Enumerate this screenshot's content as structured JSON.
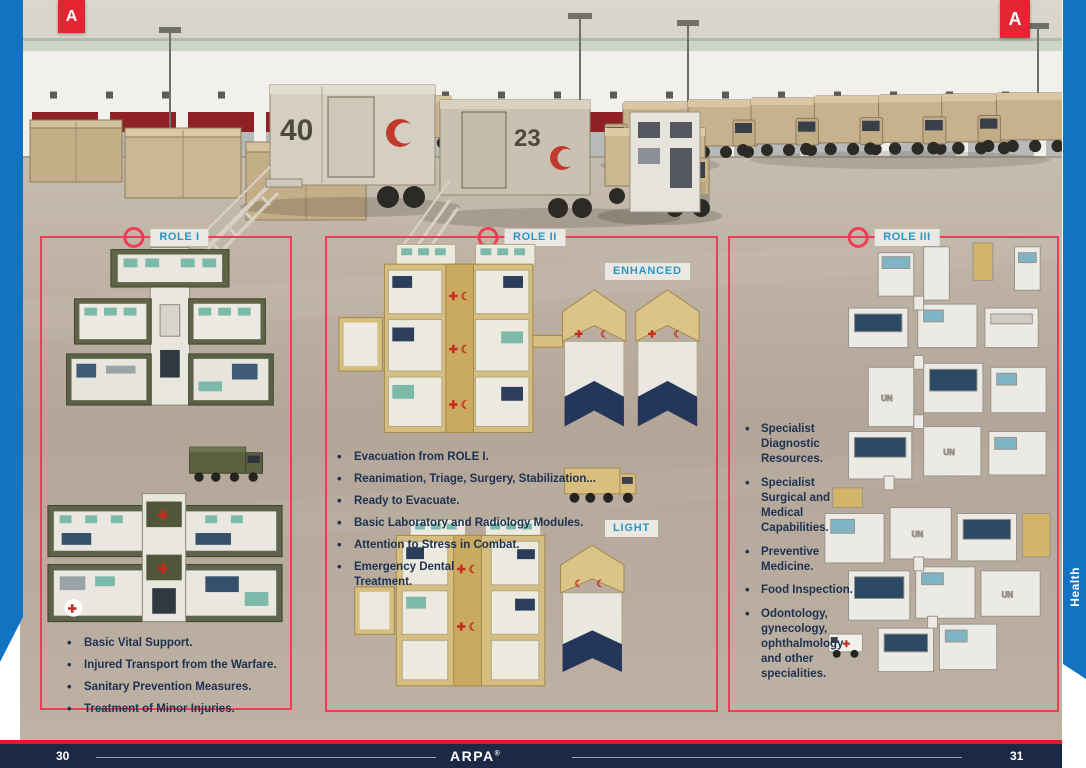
{
  "page": {
    "corner_badge_letter": "A",
    "side_tab_label": "Health",
    "footer": {
      "left_page_number": "30",
      "brand": "ARPA",
      "brand_mark": "®",
      "right_page_number": "31"
    }
  },
  "photo": {
    "container_number_1": "40",
    "container_number_2": "23"
  },
  "icons": {
    "red_cross": "✚",
    "red_crescent": "☾"
  },
  "renders": {
    "un_label": "UN"
  },
  "roles": [
    {
      "label": "ROLE I",
      "bullets": [
        "Basic Vital Support.",
        "Injured Transport from the Warfare.",
        "Sanitary Prevention Measures.",
        "Treatment of Minor Injuries."
      ]
    },
    {
      "label": "ROLE II",
      "variants": {
        "enhanced": "ENHANCED",
        "light": "LIGHT"
      },
      "bullets": [
        "Evacuation from ROLE I.",
        "Reanimation, Triage, Surgery, Stabilization...",
        "Ready to Evacuate.",
        "Basic Laboratory and Radiology Modules.",
        "Attention to Stress in Combat.",
        "Emergency Dental Treatment."
      ]
    },
    {
      "label": "ROLE III",
      "bullets": [
        "Specialist Diagnostic Resources.",
        "Specialist Surgical and Medical Capabilities.",
        "Preventive Medicine.",
        "Food Inspection.",
        "Odontology, gynecology, ophthalmology and other specialities."
      ]
    }
  ],
  "colors": {
    "accent_red": "#e42634",
    "panel_border_red": "#f23b55",
    "label_blue": "#2e96c4",
    "strip_blue": "#1173c1",
    "footer_navy": "#1b2945",
    "footer_line_red": "#e0182d"
  }
}
